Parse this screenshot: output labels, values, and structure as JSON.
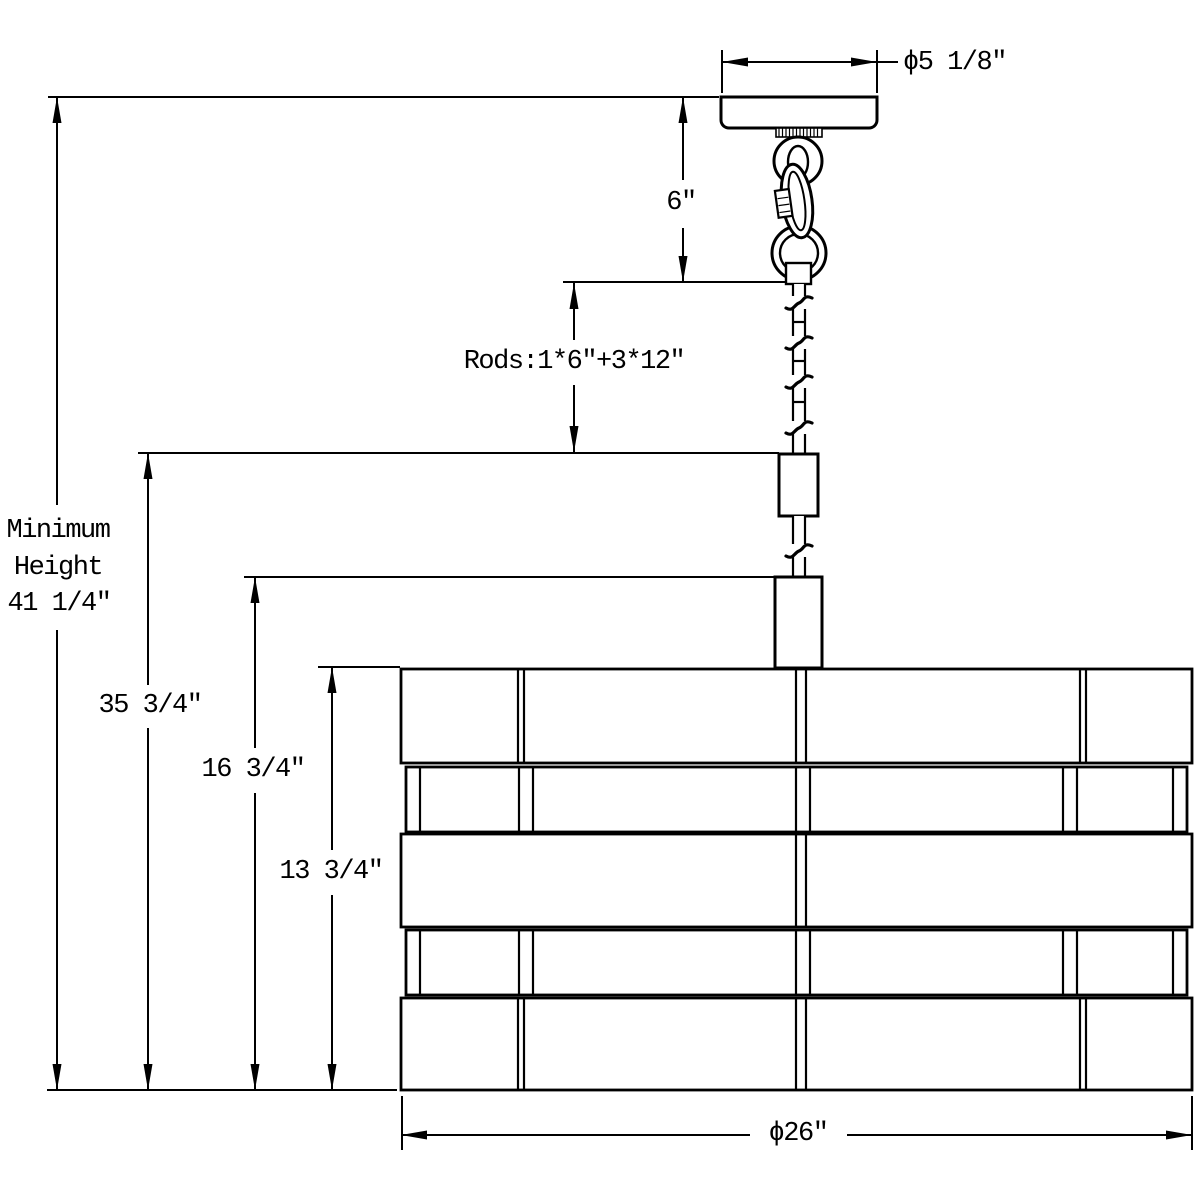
{
  "dimensions": {
    "canopy_diameter": "ϕ5 1/8″",
    "chain": "6″",
    "rods": "Rods:1*6″+3*12″",
    "minimum_height": {
      "line1": "Minimum",
      "line2": "Height",
      "line3": "41 1/4″"
    },
    "d35": "35 3/4″",
    "d16": "16 3/4″",
    "d13": "13 3/4″",
    "shade_diameter": "ϕ26″"
  },
  "colors": {
    "line": "#000000",
    "background": "#ffffff"
  }
}
